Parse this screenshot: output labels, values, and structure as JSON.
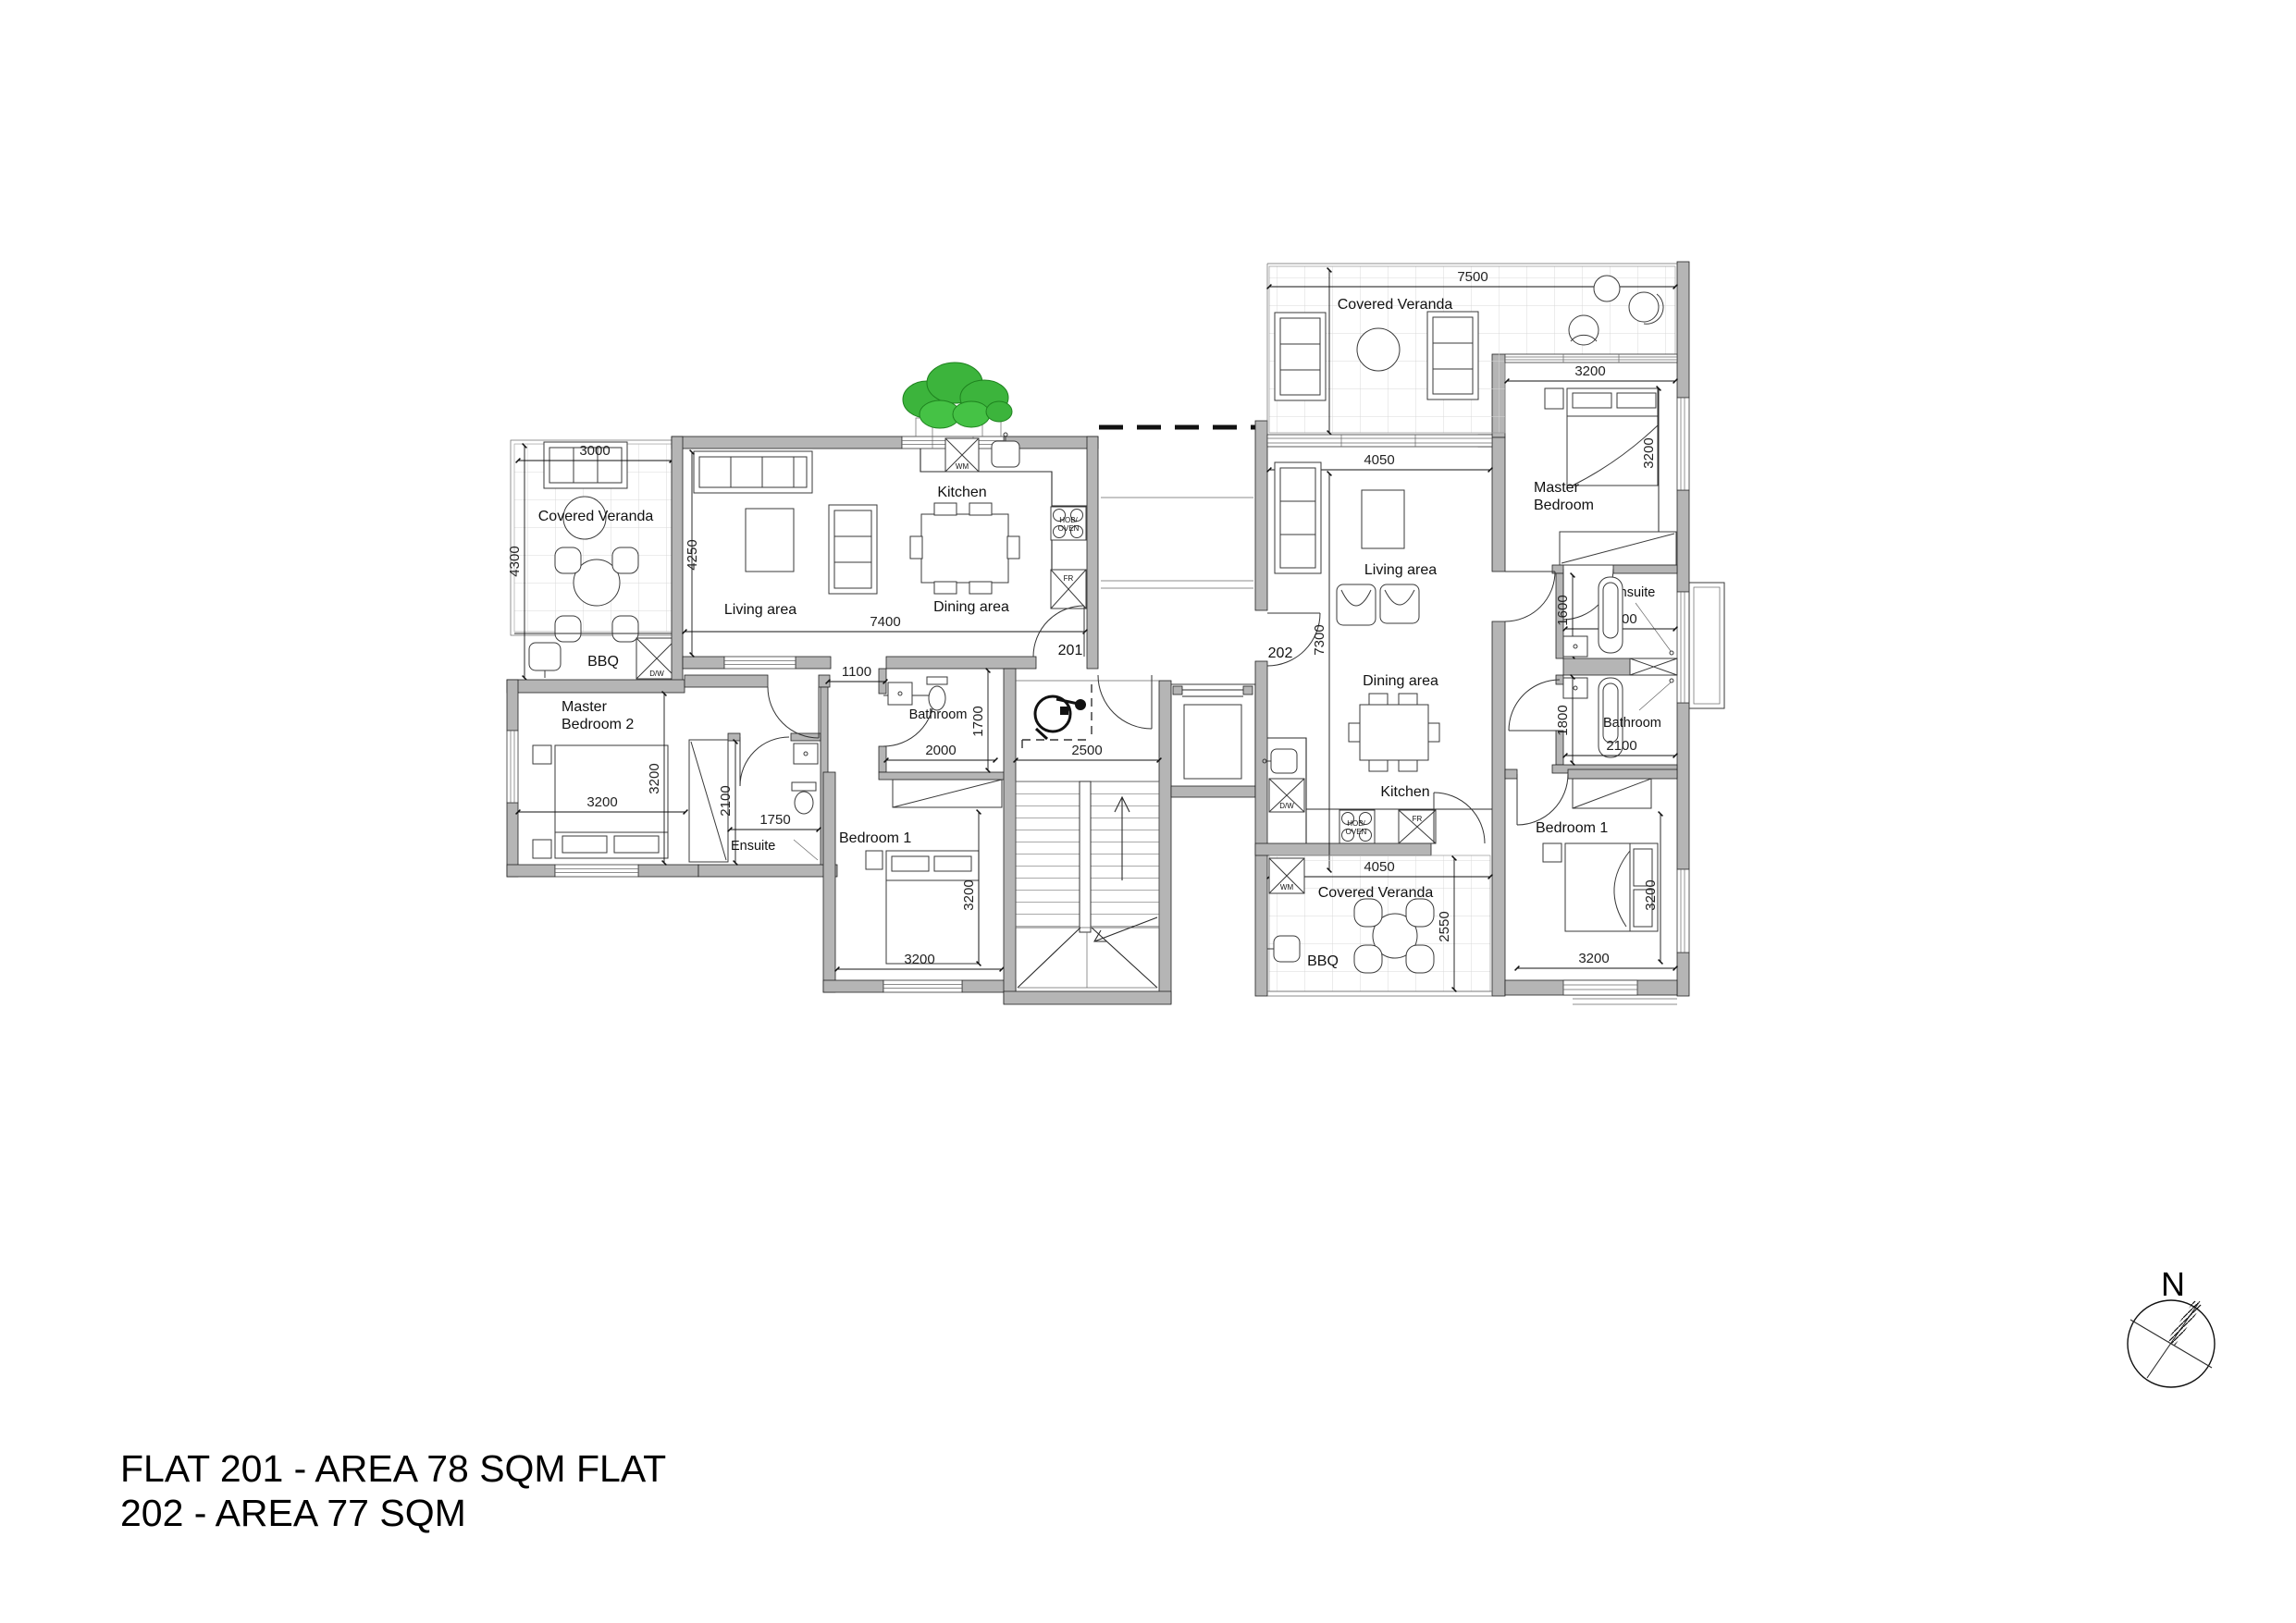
{
  "title": {
    "line1": "FLAT 201 - AREA 78 SQM FLAT",
    "line2": "202 - AREA 77 SQM"
  },
  "compass": {
    "north": "N"
  },
  "shared": {
    "wm": "WM",
    "dw": "D/W",
    "hob1": "HOB/",
    "hob2": "OVEN",
    "fr": "FR"
  },
  "flat201": {
    "door": "201",
    "rooms": {
      "veranda": "Covered Veranda",
      "bbq": "BBQ",
      "living": "Living  area",
      "kitchen": "Kitchen",
      "dining": "Dining  area",
      "mb2_line1": "Master",
      "mb2_line2": "Bedroom 2",
      "ensuite": "Ensuite",
      "bathroom": "Bathroom",
      "bedroom1": "Bedroom 1"
    },
    "dims": {
      "veranda_w": "3000",
      "veranda_h": "4300",
      "living_h": "4250",
      "living_w": "7400",
      "hall_w": "1100",
      "mb2_w": "3200",
      "mb2_h": "3200",
      "closet_d": "2100",
      "ensuite_w": "1750",
      "bath_w": "2000",
      "bath_h": "1700",
      "bed1_w": "3200",
      "bed1_h": "3200",
      "stair_w": "2500"
    }
  },
  "flat202": {
    "door": "202",
    "rooms": {
      "veranda_top": "Covered Veranda",
      "living": "Living  area",
      "dining": "Dining  area",
      "kitchen": "Kitchen",
      "mb_line1": "Master",
      "mb_line2": "Bedroom",
      "ensuite": "Ensuite",
      "bathroom": "Bathroom",
      "bedroom1": "Bedroom 1",
      "veranda_bottom": "Covered Veranda",
      "bbq": "BBQ"
    },
    "dims": {
      "veranda_top_w": "7500",
      "veranda_top_h": "3150",
      "living_w": "4050",
      "living_h": "7300",
      "mb_w": "3200",
      "mb_h": "3200",
      "ensuite_h": "1600",
      "ensuite_w": "2100",
      "bath_h": "1800",
      "bath_w": "2100",
      "bed1_w": "3200",
      "bed1_h": "3200",
      "veranda_bottom_w": "4050",
      "veranda_bottom_h": "2550"
    }
  },
  "colors": {
    "wall": "#b5b5b5",
    "line": "#2b2b2b",
    "tree": "#3cb43c"
  }
}
